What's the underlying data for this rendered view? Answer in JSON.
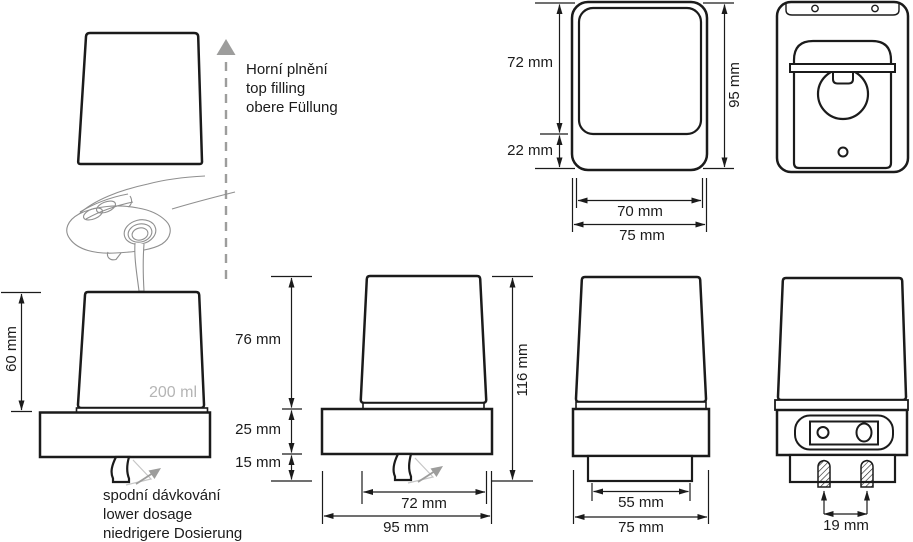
{
  "colors": {
    "line": "#1b1b1b",
    "gray_accent": "#9d9d9c",
    "light_gray": "#c6c6c6",
    "muted_text": "#b5b5b5"
  },
  "annotations": {
    "top_filling": {
      "cz": "Horní plnění",
      "en": "top filling",
      "de": "obere Füllung"
    },
    "lower_dosage": {
      "cz": "spodní dávkování",
      "en": "lower dosage",
      "de": "niedrigere Dosierung"
    },
    "capacity": "200 ml"
  },
  "views": {
    "left_front": {
      "cup_height": "60 mm"
    },
    "front": {
      "cup_height": "76 mm",
      "base_height": "25 mm",
      "nozzle_height": "15 mm",
      "total_height": "116 mm",
      "cup_width": "72 mm",
      "total_width": "95 mm"
    },
    "side": {
      "lower_width": "55 mm",
      "total_width": "75 mm"
    },
    "back": {
      "screw_spacing": "19 mm"
    },
    "top": {
      "body_depth": "72 mm",
      "front_depth": "22 mm",
      "total_depth": "95 mm",
      "inner_width": "70 mm",
      "total_width": "75 mm"
    }
  }
}
